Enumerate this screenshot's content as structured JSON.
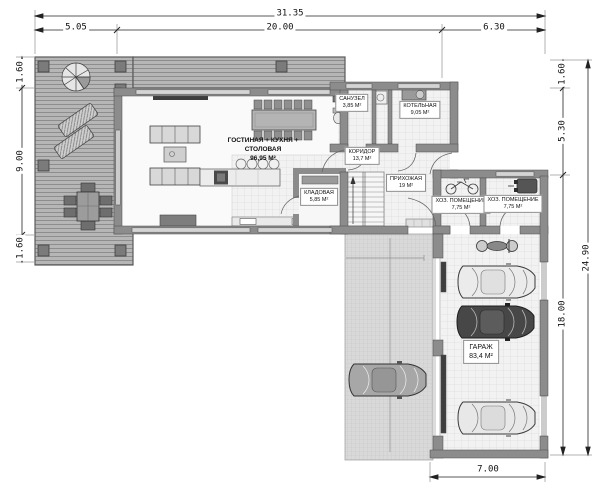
{
  "plan_type": "first-floor-plan",
  "dims": {
    "top": {
      "total": "31.35",
      "segments": [
        "5.05",
        "20.00",
        "6.30"
      ]
    },
    "left": {
      "segments": [
        "1.60",
        "9.00",
        "1.60"
      ]
    },
    "right": {
      "total": "24.90",
      "segments": [
        "1.60",
        "5.30",
        "18.00"
      ]
    },
    "bottom": {
      "segments": [
        "7.00"
      ]
    }
  },
  "rooms": {
    "living": {
      "name": "ГОСТИНАЯ + КУХНЯ + СТОЛОВАЯ",
      "area": "96,95 М²"
    },
    "kladovaya": {
      "name": "КЛАДОВАЯ",
      "area": "5,85 М²"
    },
    "sanuzel": {
      "name": "САНУЗЕЛ",
      "area": "3,85 М²"
    },
    "kotelnaya": {
      "name": "КОТЕЛЬНАЯ",
      "area": "9,05 М²"
    },
    "koridor": {
      "name": "КОРИДОР",
      "area": "13,7 М²"
    },
    "prihozhaya": {
      "name": "ПРИХОЖАЯ",
      "area": "19 М²"
    },
    "hoz1": {
      "name": "ХОЗ. ПОМЕЩЕНИЕ",
      "area": "7,75 М²"
    },
    "hoz2": {
      "name": "ХОЗ. ПОМЕЩЕНИЕ",
      "area": "7,75 М²"
    },
    "garage": {
      "name": "ГАРАЖ",
      "area": "83,4 М²"
    }
  },
  "colors": {
    "wall": "#8c8c8c",
    "deck": "#b6b6b6",
    "tile": "#f2f2f2",
    "paving": "#d9d9d9",
    "dim_line": "#222222"
  }
}
